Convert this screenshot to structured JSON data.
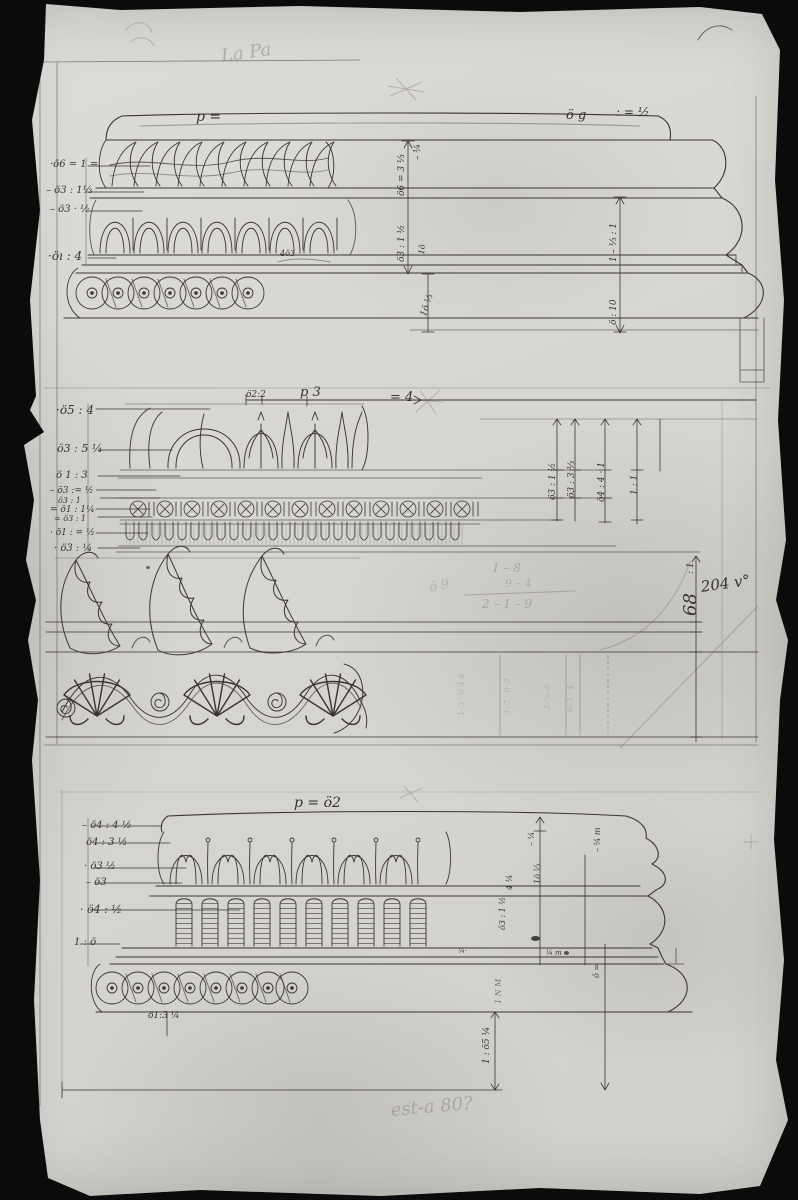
{
  "colors": {
    "ink": "#36332d",
    "pencil": "#8d8a80",
    "paper": "#d8d7d3",
    "photo_background": "#0b0b0b"
  },
  "annotations": [
    {
      "t": "La Pa",
      "x": 220,
      "y": 48,
      "s": 18,
      "r": -8,
      "c": "pencil",
      "o": 0.55
    },
    {
      "t": "p =",
      "x": 196,
      "y": 110,
      "s": 14
    },
    {
      "t": "ö g",
      "x": 566,
      "y": 109,
      "s": 13
    },
    {
      "t": ": = ½",
      "x": 616,
      "y": 106,
      "s": 12
    },
    {
      "t": "·ö6 = 1 =",
      "x": 50,
      "y": 160,
      "s": 10
    },
    {
      "t": "– ö3 : 1⅓",
      "x": 46,
      "y": 186,
      "s": 10
    },
    {
      "t": "– ö3 · ½",
      "x": 50,
      "y": 205,
      "s": 10
    },
    {
      "t": "·öı : 4",
      "x": 48,
      "y": 250,
      "s": 12
    },
    {
      "t": "– ¼",
      "x": 414,
      "y": 160,
      "s": 9,
      "r": -90
    },
    {
      "t": "ö6 = 3 ⅓",
      "x": 398,
      "y": 196,
      "s": 9,
      "r": -90
    },
    {
      "t": "ö3 : 1 ½",
      "x": 398,
      "y": 262,
      "s": 9,
      "r": -90
    },
    {
      "t": "1ö ⅓",
      "x": 420,
      "y": 315,
      "s": 9,
      "r": -72
    },
    {
      "t": "1 – ⅓ : 1",
      "x": 610,
      "y": 262,
      "s": 9,
      "r": -90
    },
    {
      "t": "ö : 10",
      "x": 610,
      "y": 325,
      "s": 9,
      "r": -90
    },
    {
      "t": "4ö3",
      "x": 280,
      "y": 250,
      "s": 8
    },
    {
      "t": "1ö",
      "x": 418,
      "y": 254,
      "s": 8,
      "r": -85
    },
    {
      "t": "ö2:2",
      "x": 246,
      "y": 391,
      "s": 9
    },
    {
      "t": "p 3",
      "x": 300,
      "y": 386,
      "s": 13
    },
    {
      "t": "= 4",
      "x": 390,
      "y": 391,
      "s": 13
    },
    {
      "t": "·ö5 : 4",
      "x": 56,
      "y": 404,
      "s": 12
    },
    {
      "t": "ö3 : 5 ¼",
      "x": 57,
      "y": 443,
      "s": 11
    },
    {
      "t": "ö 1 : 3",
      "x": 56,
      "y": 471,
      "s": 10
    },
    {
      "t": "– ö3 := ½",
      "x": 50,
      "y": 487,
      "s": 9
    },
    {
      "t": "ö3 : 1",
      "x": 58,
      "y": 497,
      "s": 8
    },
    {
      "t": "= ö1 : 1¼",
      "x": 50,
      "y": 506,
      "s": 9
    },
    {
      "t": "= ö3 : 1",
      "x": 54,
      "y": 515,
      "s": 8
    },
    {
      "t": "· ö1 : = ½",
      "x": 50,
      "y": 529,
      "s": 9
    },
    {
      "t": "· ö3 : ¼",
      "x": 54,
      "y": 544,
      "s": 10
    },
    {
      "t": "ö3 : 1 ½",
      "x": 549,
      "y": 500,
      "s": 9,
      "r": -90
    },
    {
      "t": "ö3 : 3 ⅓",
      "x": 568,
      "y": 498,
      "s": 9,
      "r": -90
    },
    {
      "t": "ö4 : 4 · 1",
      "x": 598,
      "y": 502,
      "s": 9,
      "r": -90
    },
    {
      "t": "1 : 1",
      "x": 631,
      "y": 495,
      "s": 9,
      "r": -90
    },
    {
      "t": "1 – 8",
      "x": 492,
      "y": 562,
      "s": 12,
      "c": "pencil",
      "o": 0.6
    },
    {
      "t": "9 – 4",
      "x": 505,
      "y": 578,
      "s": 11,
      "c": "pencil",
      "o": 0.45
    },
    {
      "t": "2 – 1 – 9",
      "x": 482,
      "y": 598,
      "s": 12,
      "c": "pencil",
      "o": 0.6
    },
    {
      "t": "ō 9",
      "x": 428,
      "y": 582,
      "s": 13,
      "r": -12,
      "c": "pencil",
      "o": 0.4
    },
    {
      "t": "68",
      "x": 682,
      "y": 616,
      "s": 18,
      "r": -90
    },
    {
      "t": ": 1",
      "x": 687,
      "y": 574,
      "s": 9,
      "r": -90
    },
    {
      "t": "204 v°",
      "x": 700,
      "y": 580,
      "s": 15,
      "r": -8
    },
    {
      "t": "1–3 · 0 4 6",
      "x": 458,
      "y": 716,
      "s": 8,
      "r": -90,
      "c": "pencil",
      "o": 0.4
    },
    {
      "t": "1–7 · 0–3",
      "x": 504,
      "y": 714,
      "s": 8,
      "r": -90,
      "c": "pencil",
      "o": 0.4
    },
    {
      "t": "3–¼–6",
      "x": 544,
      "y": 710,
      "s": 8,
      "r": -90,
      "c": "pencil",
      "o": 0.38
    },
    {
      "t": "0–3 · 4",
      "x": 567,
      "y": 712,
      "s": 8,
      "r": -90,
      "c": "pencil",
      "o": 0.42
    },
    {
      "t": "p = ö2",
      "x": 294,
      "y": 796,
      "s": 14
    },
    {
      "t": "– ö4 : 4 ½",
      "x": 82,
      "y": 821,
      "s": 10
    },
    {
      "t": "ö4 : 3 ½",
      "x": 86,
      "y": 838,
      "s": 10
    },
    {
      "t": "· ö3 ½",
      "x": 84,
      "y": 862,
      "s": 10
    },
    {
      "t": "– ö3",
      "x": 86,
      "y": 878,
      "s": 10
    },
    {
      "t": "· ö4 : ½",
      "x": 80,
      "y": 904,
      "s": 11
    },
    {
      "t": "1 : ö",
      "x": 74,
      "y": 938,
      "s": 10
    },
    {
      "t": "– ¼",
      "x": 528,
      "y": 846,
      "s": 8,
      "r": -90
    },
    {
      "t": "1ö ⅓",
      "x": 534,
      "y": 884,
      "s": 8,
      "r": -90
    },
    {
      "t": "4 ¼",
      "x": 506,
      "y": 890,
      "s": 8,
      "r": -90
    },
    {
      "t": "ö3 : 1 ½",
      "x": 499,
      "y": 930,
      "s": 8,
      "r": -90
    },
    {
      "t": "– ¼ m",
      "x": 594,
      "y": 852,
      "s": 8,
      "r": -90
    },
    {
      "t": "¼·",
      "x": 458,
      "y": 948,
      "s": 7
    },
    {
      "t": "¼ m",
      "x": 546,
      "y": 950,
      "s": 7
    },
    {
      "t": "ö =",
      "x": 593,
      "y": 978,
      "s": 8,
      "r": -90
    },
    {
      "t": "1 N M",
      "x": 495,
      "y": 1004,
      "s": 8,
      "r": -90,
      "o": 0.6
    },
    {
      "t": "1 : ö5 ¼",
      "x": 483,
      "y": 1064,
      "s": 9,
      "r": -90
    },
    {
      "t": "ö1:3 ¼",
      "x": 148,
      "y": 1012,
      "s": 9
    },
    {
      "t": "est-a 80?",
      "x": 390,
      "y": 1102,
      "s": 18,
      "r": -5,
      "c": "pencil",
      "o": 0.55
    }
  ]
}
